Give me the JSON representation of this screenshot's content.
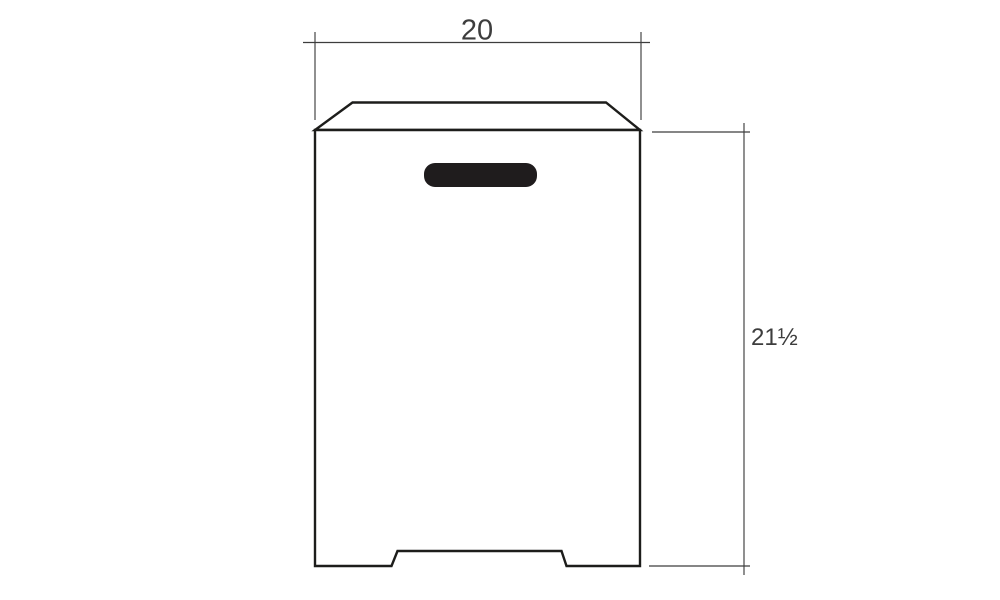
{
  "drawing": {
    "dimensions": {
      "width": {
        "label": "20"
      },
      "height": {
        "label": "21½"
      }
    },
    "colors": {
      "background": "#ffffff",
      "outline": "#1d1d1b",
      "dimension_line": "#3d3d3d",
      "handle_fill": "#1f1c1d"
    }
  }
}
